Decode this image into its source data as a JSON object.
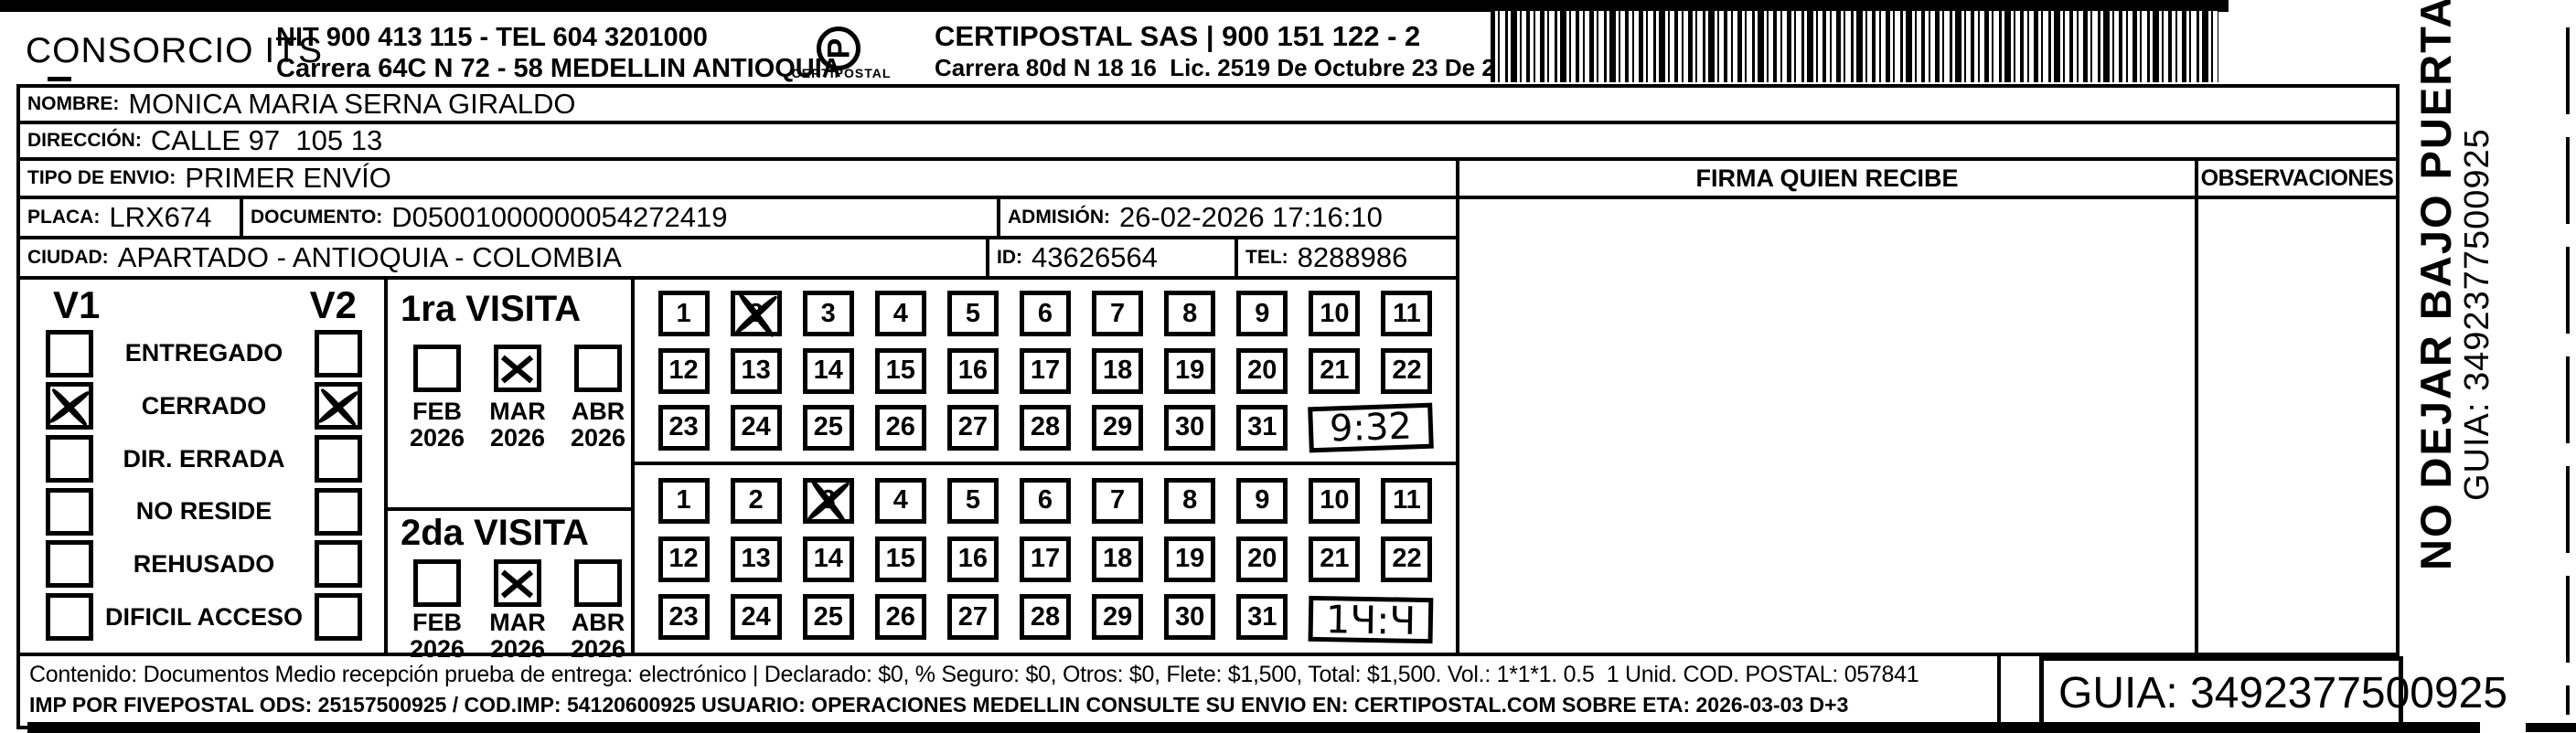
{
  "header": {
    "company": "CONSORCIO ITS",
    "nit_tel": "NIT 900 413 115 - TEL 604 3201000",
    "company_address": "Carrera 64C N 72 - 58 MEDELLIN ANTIOQUIA",
    "logo_caption": "CERTIPOSTAL",
    "carrier_name": "CERTIPOSTAL SAS | 900 151 122 - 2",
    "carrier_address": "Carrera 80d N 18 16  Lic. 2519 De Octubre 23 De 2015"
  },
  "fields": {
    "nombre": {
      "label": "NOMBRE:",
      "value": "MONICA MARIA SERNA GIRALDO"
    },
    "direccion": {
      "label": "DIRECCIÓN:",
      "value": "CALLE 97  105 13"
    },
    "tipo_envio": {
      "label": "TIPO DE ENVIO:",
      "value": "PRIMER ENVÍO"
    },
    "placa": {
      "label": "PLACA:",
      "value": "LRX674"
    },
    "documento": {
      "label": "DOCUMENTO:",
      "value": "D05001000000054272419"
    },
    "admision": {
      "label": "ADMISIÓN:",
      "value": "26-02-2026 17:16:10"
    },
    "ciudad": {
      "label": "CIUDAD:",
      "value": "APARTADO - ANTIOQUIA - COLOMBIA"
    },
    "id": {
      "label": "ID:",
      "value": "43626564"
    },
    "tel": {
      "label": "TEL:",
      "value": "8288986"
    }
  },
  "firma_header": "FIRMA QUIEN RECIBE",
  "observaciones_header": "OBSERVACIONES",
  "status_panel": {
    "col1": "V1",
    "col2": "V2",
    "rows": [
      {
        "label": "ENTREGADO",
        "v1": false,
        "v2": false
      },
      {
        "label": "CERRADO",
        "v1": true,
        "v2": true
      },
      {
        "label": "DIR. ERRADA",
        "v1": false,
        "v2": false
      },
      {
        "label": "NO RESIDE",
        "v1": false,
        "v2": false
      },
      {
        "label": "REHUSADO",
        "v1": false,
        "v2": false
      },
      {
        "label": "DIFICIL ACCESO",
        "v1": false,
        "v2": false
      }
    ]
  },
  "visits": [
    {
      "title": "1ra VISITA",
      "months": [
        {
          "month": "FEB",
          "year": "2026",
          "checked": false
        },
        {
          "month": "MAR",
          "year": "2026",
          "checked": true
        },
        {
          "month": "ABR",
          "year": "2026",
          "checked": false
        }
      ],
      "marked_day": 2,
      "hand_time": "9:32"
    },
    {
      "title": "2da VISITA",
      "months": [
        {
          "month": "FEB",
          "year": "2026",
          "checked": false
        },
        {
          "month": "MAR",
          "year": "2026",
          "checked": true
        },
        {
          "month": "ABR",
          "year": "2026",
          "checked": false
        }
      ],
      "marked_day": 3,
      "hand_time": "1Ч:Ч"
    }
  ],
  "day_grid": {
    "rows": [
      [
        1,
        2,
        3,
        4,
        5,
        6,
        7,
        8,
        9,
        10,
        11
      ],
      [
        12,
        13,
        14,
        15,
        16,
        17,
        18,
        19,
        20,
        21,
        22
      ],
      [
        23,
        24,
        25,
        26,
        27,
        28,
        29,
        30,
        31
      ]
    ]
  },
  "side_note": {
    "warning": "NO DEJAR BAJO PUERTA",
    "guia": "GUIA: 3492377500925"
  },
  "footer": {
    "line1": "Contenido: Documentos Medio recepción prueba de entrega: electrónico | Declarado: $0, % Seguro: $0, Otros: $0, Flete: $1,500, Total: $1,500. Vol.: 1*1*1. 0.5  1 Unid. COD. POSTAL: 057841",
    "line2": "IMP POR FIVEPOSTAL ODS: 25157500925 / COD.IMP: 54120600925 USUARIO: OPERACIONES MEDELLIN CONSULTE SU ENVIO EN: CERTIPOSTAL.COM SOBRE ETA: 2026-03-03 D+3",
    "guia": "GUIA: 3492377500925"
  }
}
